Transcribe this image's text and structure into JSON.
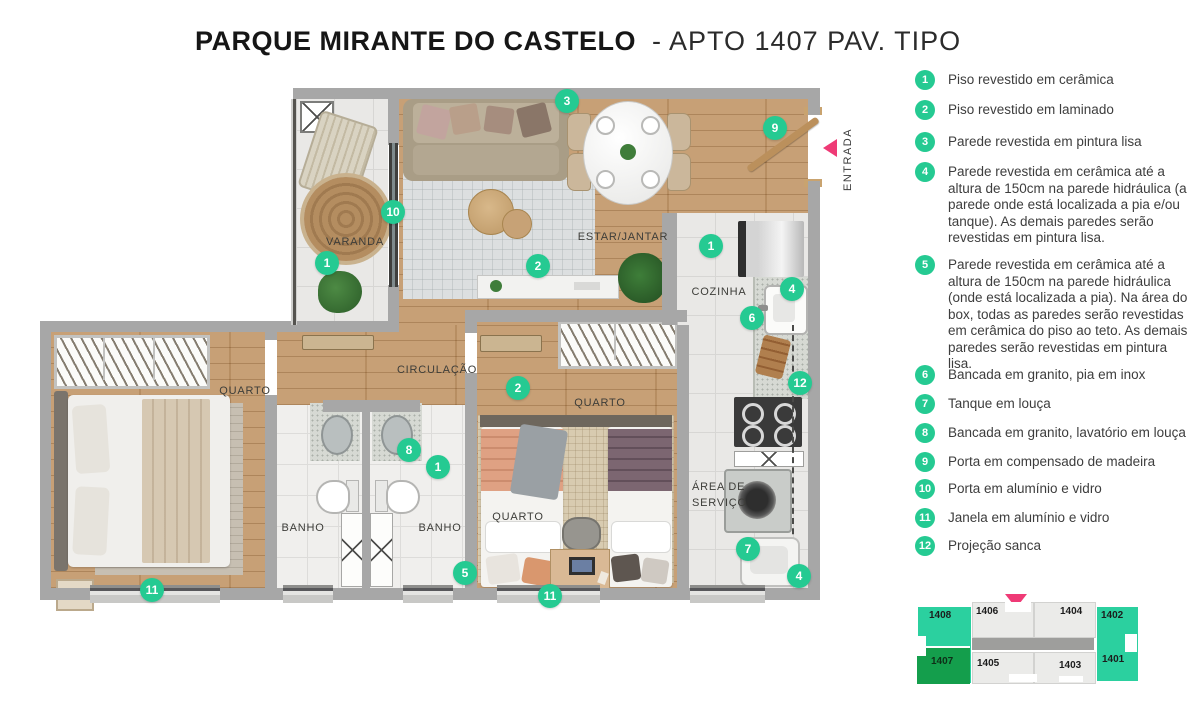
{
  "title": {
    "main": "PARQUE MIRANTE DO CASTELO",
    "suffix": "- APTO 1407 PAV. TIPO"
  },
  "legend": {
    "items": [
      {
        "num": "1",
        "text": "Piso revestido em cerâmica"
      },
      {
        "num": "2",
        "text": "Piso revestido em laminado"
      },
      {
        "num": "3",
        "text": "Parede revestida em pintura lisa"
      },
      {
        "num": "4",
        "text": "Parede revestida em cerâmica até a altura de 150cm na parede hidráulica (a parede onde está localizada a pia e/ou tanque). As demais paredes serão revestidas em pintura lisa."
      },
      {
        "num": "5",
        "text": "Parede revestida em cerâmica até a altura de 150cm na parede hidráulica (onde está localizada a pia). Na área do box, todas as paredes serão revestidas em cerâmica do piso ao teto. As demais paredes serão revestidas em pintura lisa."
      },
      {
        "num": "6",
        "text": "Bancada em granito, pia em inox"
      },
      {
        "num": "7",
        "text": "Tanque em louça"
      },
      {
        "num": "8",
        "text": "Bancada em granito, lavatório em louça"
      },
      {
        "num": "9",
        "text": "Porta em compensado de madeira"
      },
      {
        "num": "10",
        "text": "Porta em alumínio e vidro"
      },
      {
        "num": "11",
        "text": "Janela em alumínio e vidro"
      },
      {
        "num": "12",
        "text": "Projeção sanca"
      }
    ]
  },
  "plan": {
    "rooms": {
      "varanda": "VARANDA",
      "estar": "ESTAR/JANTAR",
      "cozinha": "COZINHA",
      "circulacao": "CIRCULAÇÃO",
      "quarto": "QUARTO",
      "banho": "BANHO",
      "area_servico": "ÁREA DE SERVIÇO",
      "entrada": "ENTRADA"
    },
    "markers": [
      {
        "num": "3"
      },
      {
        "num": "9"
      },
      {
        "num": "10"
      },
      {
        "num": "1"
      },
      {
        "num": "2"
      },
      {
        "num": "1"
      },
      {
        "num": "4"
      },
      {
        "num": "6"
      },
      {
        "num": "12"
      },
      {
        "num": "2"
      },
      {
        "num": "8"
      },
      {
        "num": "1"
      },
      {
        "num": "5"
      },
      {
        "num": "7"
      },
      {
        "num": "4"
      },
      {
        "num": "11"
      },
      {
        "num": "11"
      }
    ]
  },
  "keyplan": {
    "highlighted_unit": "1407",
    "units": {
      "n1408": "1408",
      "n1406": "1406",
      "n1404": "1404",
      "n1402": "1402",
      "n1407": "1407",
      "n1405": "1405",
      "n1403": "1403",
      "n1401": "1401"
    }
  },
  "colors": {
    "marker_green": "#25ca92",
    "keyplan_mint": "#2bd09f",
    "keyplan_highlight_green": "#149e4c",
    "keyplan_gray": "#ebebe9",
    "arrow_pink": "#ef3a76",
    "wall_gray": "#a7a7a7",
    "wood_floor": "#c29769"
  }
}
